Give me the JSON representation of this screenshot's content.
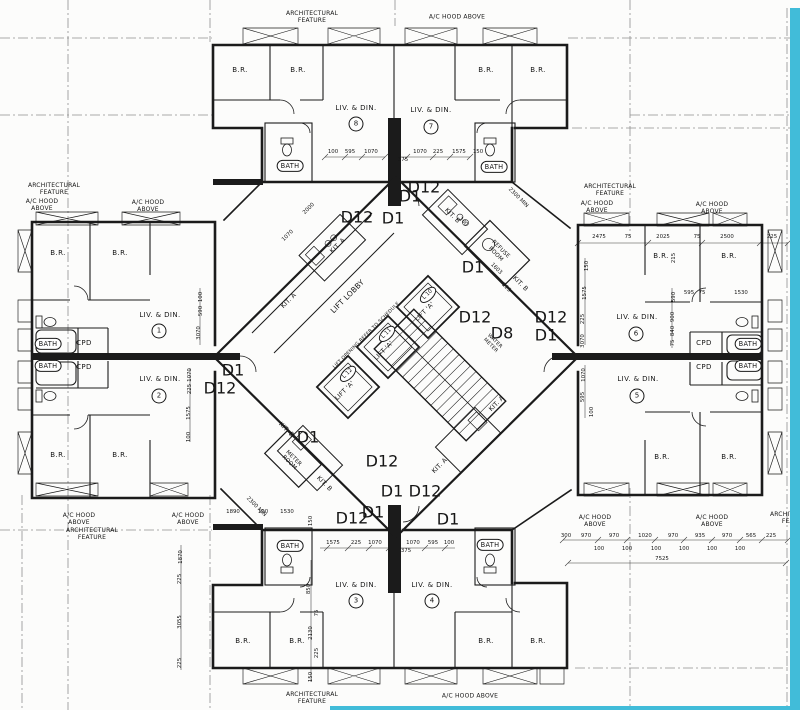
{
  "colors": {
    "paper": "#fcfcfb",
    "ink": "#1b1b1b",
    "stripe": "#41bcd9"
  },
  "annotations": {
    "notes": [
      {
        "n": "arch-feature-top",
        "t": "ARCHITECTURAL\nFEATURE",
        "x": 312,
        "y": 17
      },
      {
        "n": "ac-hood-top",
        "t": "A/C HOOD ABOVE",
        "x": 457,
        "y": 17
      },
      {
        "n": "arch-feature-left-top",
        "t": "ARCHITECTURAL\nFEATURE",
        "x": 54,
        "y": 189
      },
      {
        "n": "ac-hood-left-top-1",
        "t": "A/C HOOD\nABOVE",
        "x": 42,
        "y": 205
      },
      {
        "n": "ac-hood-left-top-2",
        "t": "A/C HOOD\nABOVE",
        "x": 148,
        "y": 206
      },
      {
        "n": "arch-feature-right-top",
        "t": "ARCHITECTURAL\nFEATURE",
        "x": 610,
        "y": 190
      },
      {
        "n": "ac-hood-right-top-1",
        "t": "A/C HOOD\nABOVE",
        "x": 597,
        "y": 207
      },
      {
        "n": "ac-hood-right-top-2",
        "t": "A/C HOOD\nABOVE",
        "x": 712,
        "y": 208
      },
      {
        "n": "ac-hood-left-bot-1",
        "t": "A/C HOOD\nABOVE",
        "x": 79,
        "y": 519
      },
      {
        "n": "arch-feature-left-bot",
        "t": "ARCHITECTURAL\nFEATURE",
        "x": 92,
        "y": 534
      },
      {
        "n": "ac-hood-left-bot-2",
        "t": "A/C HOOD\nABOVE",
        "x": 188,
        "y": 519
      },
      {
        "n": "ac-hood-right-bot-1",
        "t": "A/C HOOD\nABOVE",
        "x": 595,
        "y": 521
      },
      {
        "n": "ac-hood-right-bot-2",
        "t": "A/C HOOD\nABOVE",
        "x": 712,
        "y": 521
      },
      {
        "n": "arch-feature-right-edge",
        "t": "ARCHITECTURAL\nFEATURE",
        "x": 796,
        "y": 518
      },
      {
        "n": "arch-feature-bottom",
        "t": "ARCHITECTURAL\nFEATURE",
        "x": 312,
        "y": 698
      },
      {
        "n": "ac-hood-bottom",
        "t": "A/C HOOD ABOVE",
        "x": 470,
        "y": 696
      }
    ],
    "rooms": [
      {
        "n": "unit8-br1",
        "t": "B.R.",
        "x": 240,
        "y": 70
      },
      {
        "n": "unit8-br2",
        "t": "B.R.",
        "x": 298,
        "y": 70
      },
      {
        "n": "unit8-living",
        "t": "LIV. & DIN.",
        "x": 356,
        "y": 108
      },
      {
        "n": "unit8-number",
        "t": "8",
        "x": 356,
        "y": 124,
        "k": "circ"
      },
      {
        "n": "unit8-bath",
        "t": "BATH",
        "x": 290,
        "y": 166,
        "k": "tub"
      },
      {
        "n": "unit7-living",
        "t": "LIV. & DIN.",
        "x": 431,
        "y": 110
      },
      {
        "n": "unit7-number",
        "t": "7",
        "x": 431,
        "y": 127,
        "k": "circ"
      },
      {
        "n": "unit7-br1",
        "t": "B.R.",
        "x": 486,
        "y": 70
      },
      {
        "n": "unit7-br2",
        "t": "B.R.",
        "x": 538,
        "y": 70
      },
      {
        "n": "unit7-bath",
        "t": "BATH",
        "x": 494,
        "y": 167,
        "k": "tub"
      },
      {
        "n": "unit1-br1",
        "t": "B.R.",
        "x": 58,
        "y": 253
      },
      {
        "n": "unit1-br2",
        "t": "B.R.",
        "x": 120,
        "y": 253
      },
      {
        "n": "unit1-living",
        "t": "LIV. & DIN.",
        "x": 160,
        "y": 315
      },
      {
        "n": "unit1-number",
        "t": "1",
        "x": 159,
        "y": 331,
        "k": "circ"
      },
      {
        "n": "unit1-bath",
        "t": "BATH",
        "x": 48,
        "y": 344,
        "k": "tub"
      },
      {
        "n": "unit1-cpd",
        "t": "CPD",
        "x": 84,
        "y": 343
      },
      {
        "n": "unit2-bath",
        "t": "BATH",
        "x": 48,
        "y": 366,
        "k": "tub"
      },
      {
        "n": "unit2-cpd",
        "t": "CPD",
        "x": 84,
        "y": 367
      },
      {
        "n": "unit2-living",
        "t": "LIV. & DIN.",
        "x": 160,
        "y": 379
      },
      {
        "n": "unit2-number",
        "t": "2",
        "x": 159,
        "y": 396,
        "k": "circ"
      },
      {
        "n": "unit2-br1",
        "t": "B.R.",
        "x": 58,
        "y": 455
      },
      {
        "n": "unit2-br2",
        "t": "B.R.",
        "x": 120,
        "y": 455
      },
      {
        "n": "unit6-br1",
        "t": "B.R.",
        "x": 661,
        "y": 256
      },
      {
        "n": "unit6-br2",
        "t": "B.R.",
        "x": 729,
        "y": 256
      },
      {
        "n": "unit6-living",
        "t": "LIV. & DIN.",
        "x": 637,
        "y": 317
      },
      {
        "n": "unit6-number",
        "t": "6",
        "x": 636,
        "y": 334,
        "k": "circ"
      },
      {
        "n": "unit6-cpd",
        "t": "CPD",
        "x": 704,
        "y": 343
      },
      {
        "n": "unit6-bath",
        "t": "BATH",
        "x": 748,
        "y": 344,
        "k": "tub"
      },
      {
        "n": "unit5-cpd",
        "t": "CPD",
        "x": 704,
        "y": 367
      },
      {
        "n": "unit5-bath",
        "t": "BATH",
        "x": 748,
        "y": 366,
        "k": "tub"
      },
      {
        "n": "unit5-living",
        "t": "LIV. & DIN.",
        "x": 638,
        "y": 379
      },
      {
        "n": "unit5-number",
        "t": "5",
        "x": 637,
        "y": 396,
        "k": "circ"
      },
      {
        "n": "unit5-br1",
        "t": "B.R.",
        "x": 662,
        "y": 457
      },
      {
        "n": "unit5-br2",
        "t": "B.R.",
        "x": 729,
        "y": 457
      },
      {
        "n": "unit3-bath",
        "t": "BATH",
        "x": 290,
        "y": 546,
        "k": "tub"
      },
      {
        "n": "unit3-living",
        "t": "LIV. & DIN.",
        "x": 356,
        "y": 585
      },
      {
        "n": "unit3-number",
        "t": "3",
        "x": 356,
        "y": 601,
        "k": "circ"
      },
      {
        "n": "unit3-br1",
        "t": "B.R.",
        "x": 243,
        "y": 641
      },
      {
        "n": "unit3-br2",
        "t": "B.R.",
        "x": 297,
        "y": 641
      },
      {
        "n": "unit4-living",
        "t": "LIV. & DIN.",
        "x": 432,
        "y": 585
      },
      {
        "n": "unit4-number",
        "t": "4",
        "x": 432,
        "y": 601,
        "k": "circ"
      },
      {
        "n": "unit4-bath",
        "t": "BATH",
        "x": 490,
        "y": 545,
        "k": "tub"
      },
      {
        "n": "unit4-br1",
        "t": "B.R.",
        "x": 486,
        "y": 641
      },
      {
        "n": "unit4-br2",
        "t": "B.R.",
        "x": 538,
        "y": 641
      }
    ],
    "core": [
      {
        "n": "kitchen-a-unit8",
        "t": "KIT. A",
        "x": 338,
        "y": 246,
        "r": -45
      },
      {
        "n": "kitchen-a-unit1",
        "t": "KIT. A",
        "x": 289,
        "y": 301,
        "r": -45
      },
      {
        "n": "kitchen-b-unit7",
        "t": "KIT. B",
        "x": 452,
        "y": 216,
        "r": 45
      },
      {
        "n": "kitchen-b-unit6",
        "t": "KIT. B",
        "x": 520,
        "y": 284,
        "r": 45
      },
      {
        "n": "refuse-room",
        "t": "REFUSE\nROOM",
        "x": 498,
        "y": 252,
        "r": 45,
        "s": 5.6
      },
      {
        "n": "lift-lobby",
        "t": "LIFT LOBBY",
        "x": 348,
        "y": 297,
        "r": -45,
        "s": 7.5
      },
      {
        "n": "lift-opening-note",
        "t": "LIFT OPENING REFER TO SCHEDULE",
        "x": 367,
        "y": 336,
        "r": -45,
        "s": 4.8
      },
      {
        "n": "lift10-tag",
        "t": "L 10",
        "x": 428,
        "y": 295,
        "r": -45,
        "k": "oval"
      },
      {
        "n": "lift10-label",
        "t": "LIFT 'A'",
        "x": 425,
        "y": 312,
        "r": -45
      },
      {
        "n": "lift11-tag",
        "t": "L 11",
        "x": 387,
        "y": 334,
        "r": -45,
        "k": "oval"
      },
      {
        "n": "lift11-label",
        "t": "LIFT 'A'",
        "x": 384,
        "y": 351,
        "r": -45
      },
      {
        "n": "lift12-tag",
        "t": "L 12",
        "x": 348,
        "y": 374,
        "r": -45,
        "k": "oval"
      },
      {
        "n": "lift12-label",
        "t": "LIFT 'A'",
        "x": 345,
        "y": 391,
        "r": -45
      },
      {
        "n": "water-meter",
        "t": "WATER\nMETER",
        "x": 492,
        "y": 344,
        "r": 45,
        "s": 5
      },
      {
        "n": "kitchen-a-unit5",
        "t": "KIT. A",
        "x": 497,
        "y": 404,
        "r": -45
      },
      {
        "n": "kitchen-a-unit4",
        "t": "KIT. A",
        "x": 440,
        "y": 466,
        "r": -45
      },
      {
        "n": "kitchen-b-unit3",
        "t": "KIT. B",
        "x": 324,
        "y": 484,
        "r": 45
      },
      {
        "n": "kitchen-b-unit2",
        "t": "KIT. B",
        "x": 286,
        "y": 430,
        "r": 45
      },
      {
        "n": "meter-room",
        "t": "METER\nROOM",
        "x": 291,
        "y": 461,
        "r": 45,
        "s": 5.5
      }
    ],
    "doors": [
      {
        "t": "D1",
        "x": 410,
        "y": 197
      },
      {
        "t": "D12",
        "x": 424,
        "y": 188
      },
      {
        "t": "D12",
        "x": 357,
        "y": 218
      },
      {
        "t": "D1",
        "x": 393,
        "y": 219
      },
      {
        "t": "D1",
        "x": 233,
        "y": 371
      },
      {
        "t": "D12",
        "x": 220,
        "y": 389
      },
      {
        "t": "D1",
        "x": 473,
        "y": 268
      },
      {
        "t": "D12",
        "x": 475,
        "y": 318
      },
      {
        "t": "D8",
        "x": 502,
        "y": 334
      },
      {
        "t": "D12",
        "x": 551,
        "y": 318
      },
      {
        "t": "D1",
        "x": 546,
        "y": 336
      },
      {
        "t": "D1",
        "x": 308,
        "y": 438
      },
      {
        "t": "D12",
        "x": 382,
        "y": 462
      },
      {
        "t": "D1",
        "x": 392,
        "y": 492
      },
      {
        "t": "D12",
        "x": 425,
        "y": 492
      },
      {
        "t": "D1",
        "x": 373,
        "y": 513
      },
      {
        "t": "D12",
        "x": 352,
        "y": 519
      },
      {
        "t": "D1",
        "x": 448,
        "y": 520
      }
    ],
    "dims": [
      {
        "t": "100",
        "x": 333,
        "y": 152
      },
      {
        "t": "595",
        "x": 350,
        "y": 152
      },
      {
        "t": "1070",
        "x": 371,
        "y": 152
      },
      {
        "t": "375",
        "x": 403,
        "y": 160
      },
      {
        "t": "1070",
        "x": 420,
        "y": 152
      },
      {
        "t": "225",
        "x": 438,
        "y": 152
      },
      {
        "t": "1575",
        "x": 459,
        "y": 152
      },
      {
        "t": "150",
        "x": 478,
        "y": 152
      },
      {
        "t": "2475",
        "x": 599,
        "y": 237
      },
      {
        "t": "75",
        "x": 628,
        "y": 237
      },
      {
        "t": "2025",
        "x": 663,
        "y": 237
      },
      {
        "t": "75",
        "x": 697,
        "y": 237
      },
      {
        "t": "2500",
        "x": 727,
        "y": 237
      },
      {
        "t": "225",
        "x": 772,
        "y": 237
      },
      {
        "t": "595",
        "x": 689,
        "y": 293
      },
      {
        "t": "75",
        "x": 702,
        "y": 293
      },
      {
        "t": "1530",
        "x": 741,
        "y": 293
      },
      {
        "t": "215",
        "x": 674,
        "y": 258,
        "r": -90
      },
      {
        "t": "150",
        "x": 587,
        "y": 266,
        "r": -90
      },
      {
        "t": "1575",
        "x": 585,
        "y": 293,
        "r": -90
      },
      {
        "t": "225",
        "x": 583,
        "y": 319,
        "r": -90
      },
      {
        "t": "3070",
        "x": 583,
        "y": 341,
        "r": -90
      },
      {
        "t": "1070",
        "x": 584,
        "y": 375,
        "r": -90
      },
      {
        "t": "595",
        "x": 583,
        "y": 397,
        "r": -90
      },
      {
        "t": "100",
        "x": 592,
        "y": 412,
        "r": -90
      },
      {
        "t": "590",
        "x": 674,
        "y": 297,
        "r": -90
      },
      {
        "t": "900",
        "x": 673,
        "y": 317,
        "r": -90
      },
      {
        "t": "840",
        "x": 673,
        "y": 331,
        "r": -90
      },
      {
        "t": "75",
        "x": 673,
        "y": 343,
        "r": -90
      },
      {
        "t": "100",
        "x": 201,
        "y": 297,
        "r": -90
      },
      {
        "t": "590",
        "x": 201,
        "y": 311,
        "r": -90
      },
      {
        "t": "3070",
        "x": 199,
        "y": 333,
        "r": -90
      },
      {
        "t": "1070",
        "x": 190,
        "y": 375,
        "r": -90
      },
      {
        "t": "225",
        "x": 190,
        "y": 389,
        "r": -90
      },
      {
        "t": "1575",
        "x": 189,
        "y": 413,
        "r": -90
      },
      {
        "t": "100",
        "x": 189,
        "y": 437,
        "r": -90
      },
      {
        "t": "1870",
        "x": 181,
        "y": 557,
        "r": -90
      },
      {
        "t": "225",
        "x": 180,
        "y": 579,
        "r": -90
      },
      {
        "t": "3055",
        "x": 180,
        "y": 622,
        "r": -90
      },
      {
        "t": "225",
        "x": 180,
        "y": 663,
        "r": -90
      },
      {
        "t": "300",
        "x": 566,
        "y": 536
      },
      {
        "t": "970",
        "x": 586,
        "y": 536
      },
      {
        "t": "970",
        "x": 614,
        "y": 536
      },
      {
        "t": "1020",
        "x": 645,
        "y": 536
      },
      {
        "t": "970",
        "x": 673,
        "y": 536
      },
      {
        "t": "935",
        "x": 700,
        "y": 536
      },
      {
        "t": "970",
        "x": 727,
        "y": 536
      },
      {
        "t": "565",
        "x": 751,
        "y": 536
      },
      {
        "t": "225",
        "x": 771,
        "y": 536
      },
      {
        "t": "100",
        "x": 599,
        "y": 549
      },
      {
        "t": "100",
        "x": 627,
        "y": 549
      },
      {
        "t": "100",
        "x": 656,
        "y": 549
      },
      {
        "t": "100",
        "x": 684,
        "y": 549
      },
      {
        "t": "100",
        "x": 712,
        "y": 549
      },
      {
        "t": "100",
        "x": 740,
        "y": 549
      },
      {
        "t": "7525",
        "x": 662,
        "y": 559
      },
      {
        "t": "1575",
        "x": 333,
        "y": 543
      },
      {
        "t": "225",
        "x": 356,
        "y": 543
      },
      {
        "t": "1070",
        "x": 375,
        "y": 543
      },
      {
        "t": "375",
        "x": 406,
        "y": 551
      },
      {
        "t": "1070",
        "x": 413,
        "y": 543
      },
      {
        "t": "595",
        "x": 433,
        "y": 543
      },
      {
        "t": "100",
        "x": 449,
        "y": 543
      },
      {
        "t": "1890",
        "x": 233,
        "y": 512
      },
      {
        "t": "100",
        "x": 263,
        "y": 512
      },
      {
        "t": "1530",
        "x": 287,
        "y": 512
      },
      {
        "t": "150",
        "x": 311,
        "y": 521,
        "r": -90
      },
      {
        "t": "850",
        "x": 309,
        "y": 589,
        "r": -90
      },
      {
        "t": "75",
        "x": 317,
        "y": 613,
        "r": -90
      },
      {
        "t": "2130",
        "x": 311,
        "y": 633,
        "r": -90
      },
      {
        "t": "225",
        "x": 317,
        "y": 653,
        "r": -90
      },
      {
        "t": "150",
        "x": 311,
        "y": 677,
        "r": -90
      },
      {
        "t": "2300 MIN",
        "x": 518,
        "y": 198,
        "r": 45
      },
      {
        "t": "2300 MIN",
        "x": 256,
        "y": 507,
        "r": 45
      },
      {
        "t": "2000",
        "x": 309,
        "y": 209,
        "r": -45
      },
      {
        "t": "1070",
        "x": 288,
        "y": 236,
        "r": -45
      },
      {
        "t": "100",
        "x": 463,
        "y": 222,
        "r": 45
      },
      {
        "t": "1603",
        "x": 496,
        "y": 269,
        "r": 45
      },
      {
        "t": "225",
        "x": 506,
        "y": 288,
        "r": 45
      }
    ]
  }
}
